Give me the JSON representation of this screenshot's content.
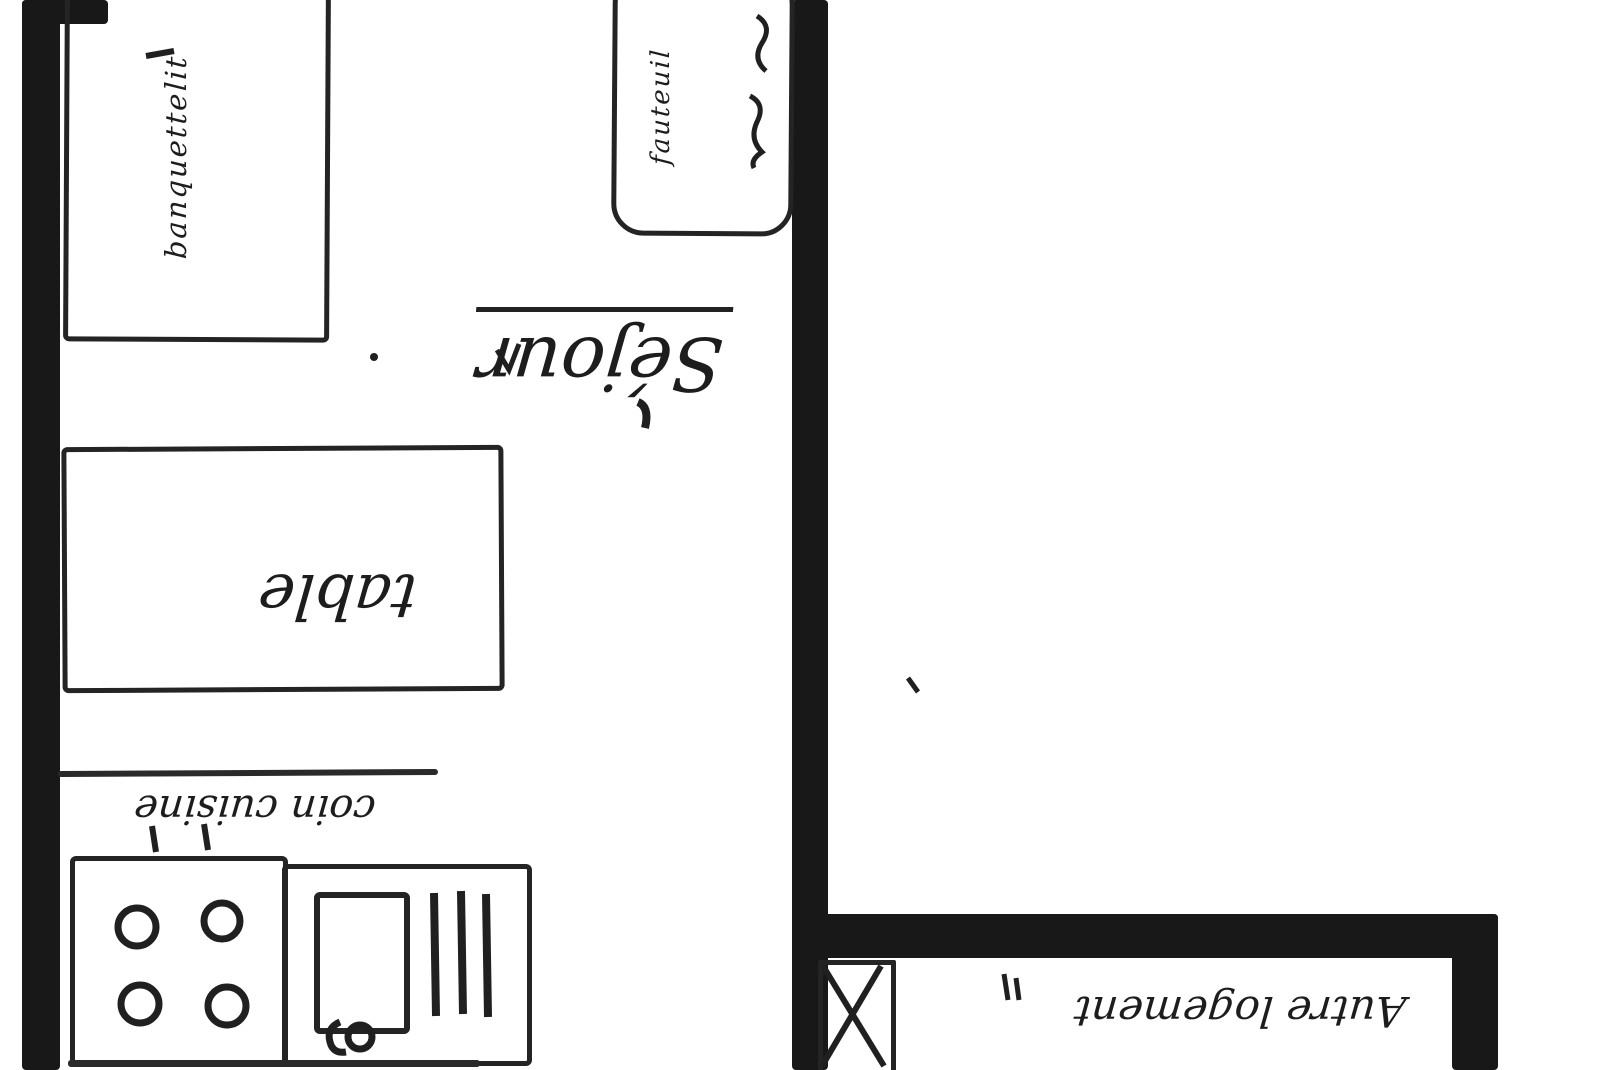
{
  "plan": {
    "rooms": {
      "sejour": "Séjour",
      "coin_cuisine": "coin cuisine",
      "autre_logement": "Autre logement"
    },
    "furniture": {
      "banquette_line1": "banquette",
      "banquette_line2": "lit",
      "table": "table",
      "fauteuil": "fauteuil"
    },
    "fixtures": {
      "stove_burners": 4,
      "drainboard_bars": 3
    },
    "colors": {
      "ink": "#1d1d1d",
      "paper": "#ffffff"
    }
  }
}
